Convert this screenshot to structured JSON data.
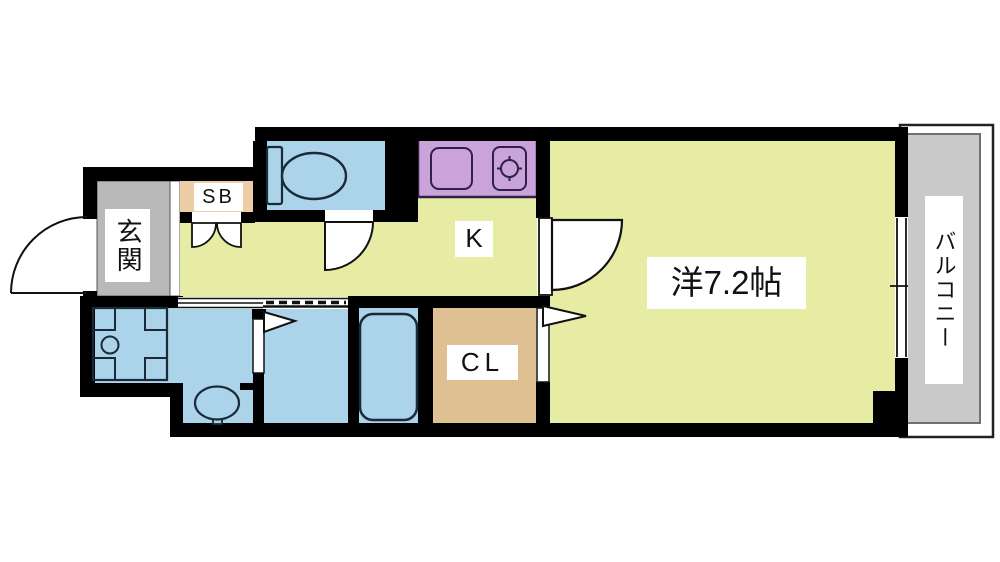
{
  "diagram": {
    "type": "floor-plan",
    "labels": {
      "entrance": "玄関",
      "shoe_box": "SB",
      "kitchen": "K",
      "closet": "CL",
      "western_room": "洋7.2帖",
      "balcony": "バルコニー"
    },
    "colors": {
      "room_yellow": "#e7eca4",
      "water_blue": "#abd3ea",
      "counter_purple": "#c9a3d9",
      "closet_tan": "#dec092",
      "shoebox_tan": "#eccda5",
      "entrance_gray": "#b9b9b9",
      "balcony_gray": "#c9c9c9",
      "wall_black": "#000000",
      "fixture_stroke": "#1b2a38"
    },
    "fixtures": [
      "toilet",
      "kitchen-sink",
      "stove-burner",
      "washing-machine-pan",
      "wash-basin",
      "bathtub"
    ]
  }
}
